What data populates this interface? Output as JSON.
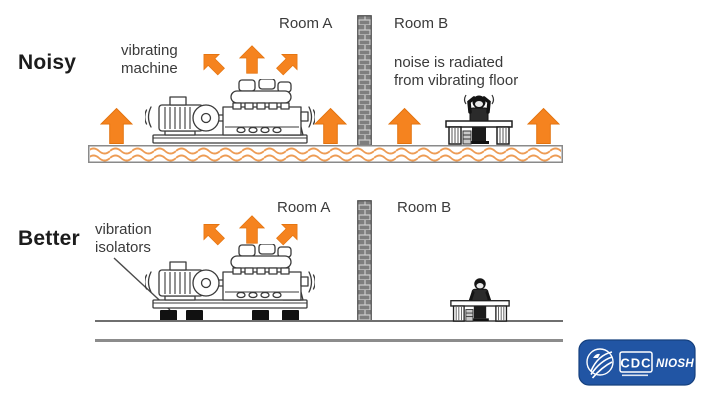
{
  "diagrams": {
    "noisy": {
      "label": "Noisy",
      "machine_label": "vibrating\nmachine",
      "room_a": "Room A",
      "room_b": "Room B",
      "note": "noise is radiated\nfrom vibrating floor"
    },
    "better": {
      "label": "Better",
      "isolators_label": "vibration\nisolators",
      "room_a": "Room A",
      "room_b": "Room B"
    }
  },
  "logo": {
    "cdc": "CDC",
    "niosh": "NIOSH"
  },
  "colors": {
    "arrow_orange": "#F5831F",
    "wave_orange": "#ED9C55",
    "logo_blue": "#2155A4",
    "text_dark": "#3A3A3A",
    "line_gray": "#777777"
  }
}
